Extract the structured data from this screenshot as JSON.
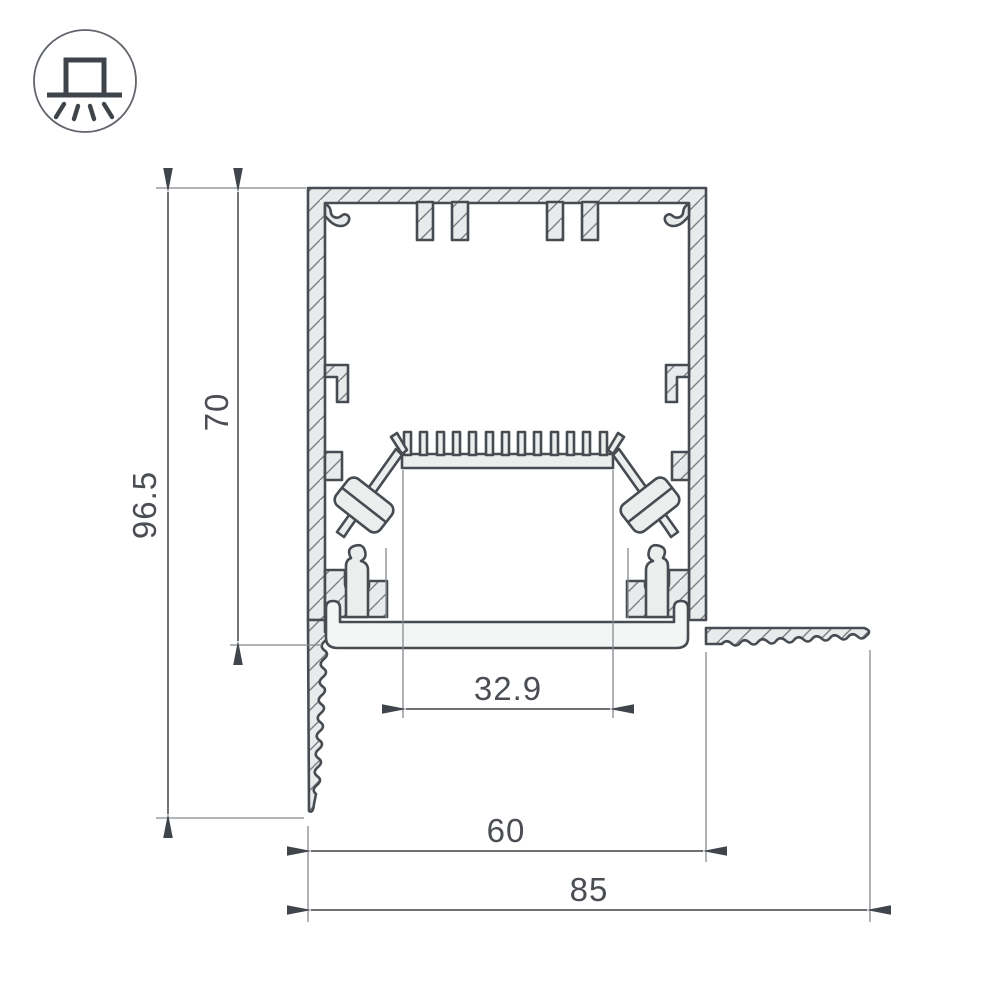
{
  "title": "LED profile cross-section drawing",
  "icon": {
    "name": "recessed-downlight-icon",
    "description": "circle badge with surface box on ceiling line and light rays below"
  },
  "dimensions": {
    "height_total": "96.5",
    "height_body": "70",
    "window_width": "32.9",
    "body_width": "60",
    "total_width": "85"
  },
  "colors": {
    "background": "#ffffff",
    "outline": "#474c52",
    "metal_fill": "#e9eaeb",
    "hatch": "#797e83",
    "dim_line": "#585c61",
    "ext_line": "#85898d",
    "text": "#4a4e53",
    "arrow": "#40454b"
  }
}
